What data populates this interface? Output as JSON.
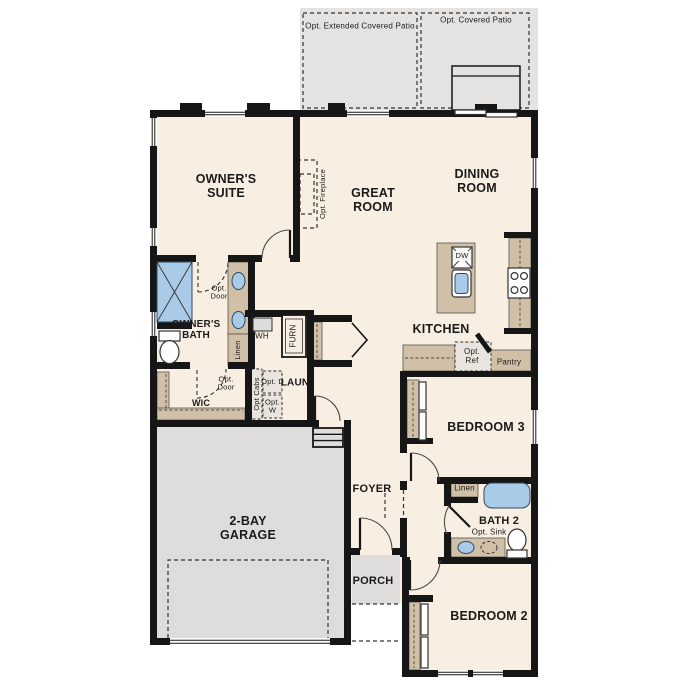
{
  "labels": {
    "opt_extended_patio": "Opt. Extended Covered Patio",
    "opt_covered_patio": "Opt. Covered Patio",
    "owners_suite": "OWNER'S SUITE",
    "great_room": "GREAT ROOM",
    "dining_room": "DINING ROOM",
    "opt_fireplace": "Opt. Fireplace",
    "kitchen": "KITCHEN",
    "owners_bath": "OWNER'S BATH",
    "opt_door_bath": "Opt. Door",
    "opt_door_wic": "Opt. Door",
    "wic": "WIC",
    "wh": "WH",
    "furnace": "FURN",
    "linen_owners": "Linen",
    "opt_cabs": "Opt Cabs",
    "opt_dryer": "Opt. D",
    "opt_washer": "Opt. W",
    "laundry": "LAUN",
    "dishwasher": "DW",
    "opt_ref": "Opt. Ref",
    "pantry": "Pantry",
    "bedroom3": "BEDROOM 3",
    "linen_bath2": "Linen",
    "bath2": "BATH 2",
    "opt_sink": "Opt. Sink",
    "bedroom2": "BEDROOM 2",
    "foyer": "FOYER",
    "porch": "PORCH",
    "garage": "2-BAY GARAGE"
  },
  "colors": {
    "floor": "#f8eee1",
    "wall": "#161616",
    "patio": "#e4e3e1",
    "garage": "#dedddb",
    "cab": "#cfc0a7",
    "blue": "#a9cbe8",
    "opt": "#e9e5de"
  }
}
